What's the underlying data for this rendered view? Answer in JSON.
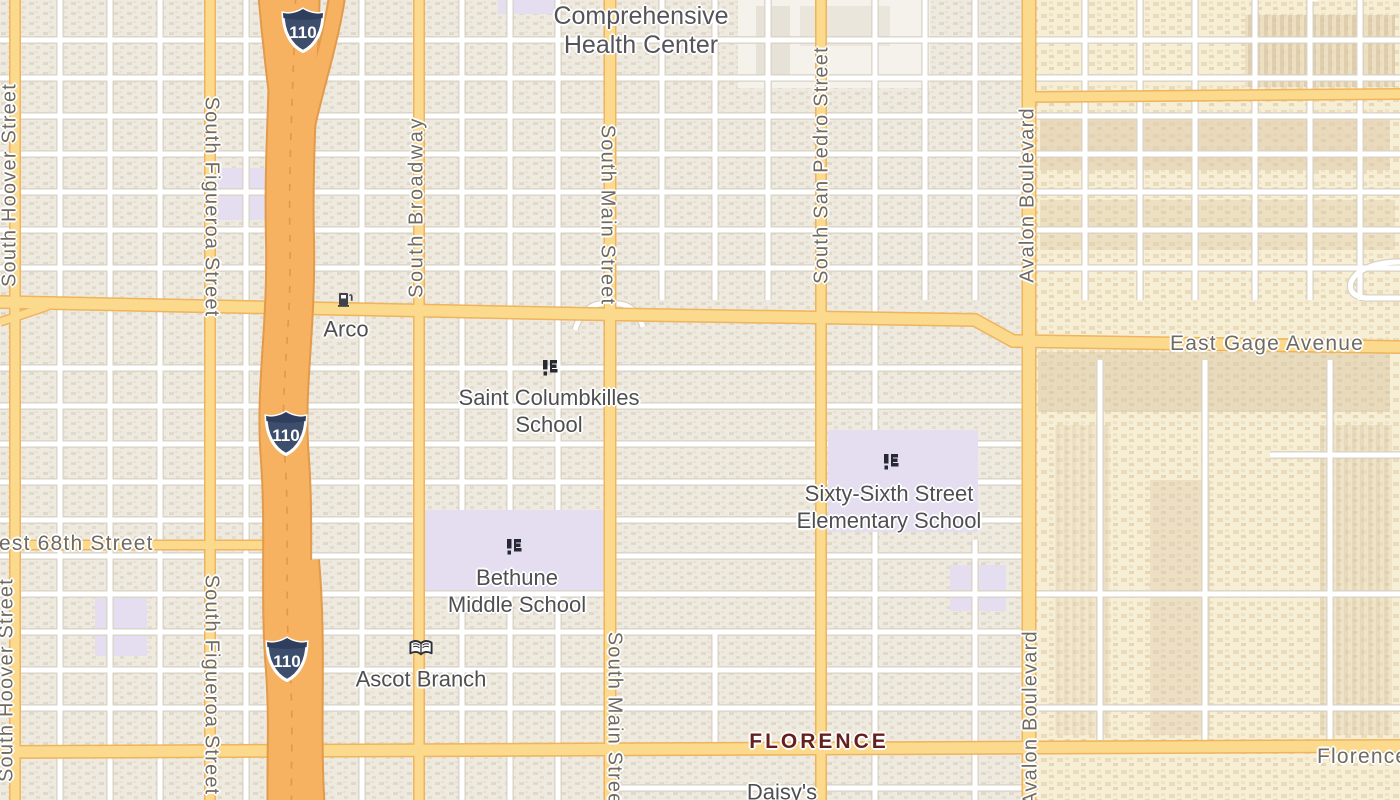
{
  "map_type": "road-map",
  "freeway": {
    "shield": "110"
  },
  "colors": {
    "freeway_fill": "#f6b161",
    "freeway_casing": "#e29a4b",
    "major_road_fill": "#fbd98d",
    "major_road_casing": "#efb45c",
    "minor_road": "#ffffff",
    "school_ground": "#e4def0",
    "land_west": "#f2eee6",
    "land_east": "#f7eed6",
    "street_label": "#6f6b62",
    "poi_label": "#4f4f52",
    "neighborhood_label": "#661f1f"
  },
  "streets": {
    "hoover": "South Hoover Street",
    "figueroa": "South Figueroa Street",
    "broadway": "South Broadway",
    "main": "South Main Street",
    "san_pedro": "South San Pedro Street",
    "avalon": "Avalon Boulevard",
    "gage": "East Gage Avenue",
    "sixty_eighth": "West 68th Street",
    "florence_avenue": "Florence Avenue"
  },
  "places": {
    "health_center": {
      "clipped_line": "Hubert H. Humphrey",
      "line1": "Comprehensive",
      "line2": "Health Center"
    },
    "northgate": {
      "label": "Northgate Market"
    },
    "arco": {
      "label": "Arco",
      "icon": "gas-pump"
    },
    "saint_columbkilles": {
      "line1": "Saint Columbkilles",
      "line2": "School",
      "icon": "school"
    },
    "sixty_sixth": {
      "line1": "Sixty-Sixth Street",
      "line2": "Elementary School",
      "icon": "school"
    },
    "bethune": {
      "line1": "Bethune",
      "line2": "Middle School",
      "icon": "school"
    },
    "ascot": {
      "label": "Ascot Branch",
      "icon": "open-book"
    },
    "florence_neighborhood": {
      "label": "FLORENCE"
    },
    "daisys": {
      "label": "Daisy's"
    }
  }
}
